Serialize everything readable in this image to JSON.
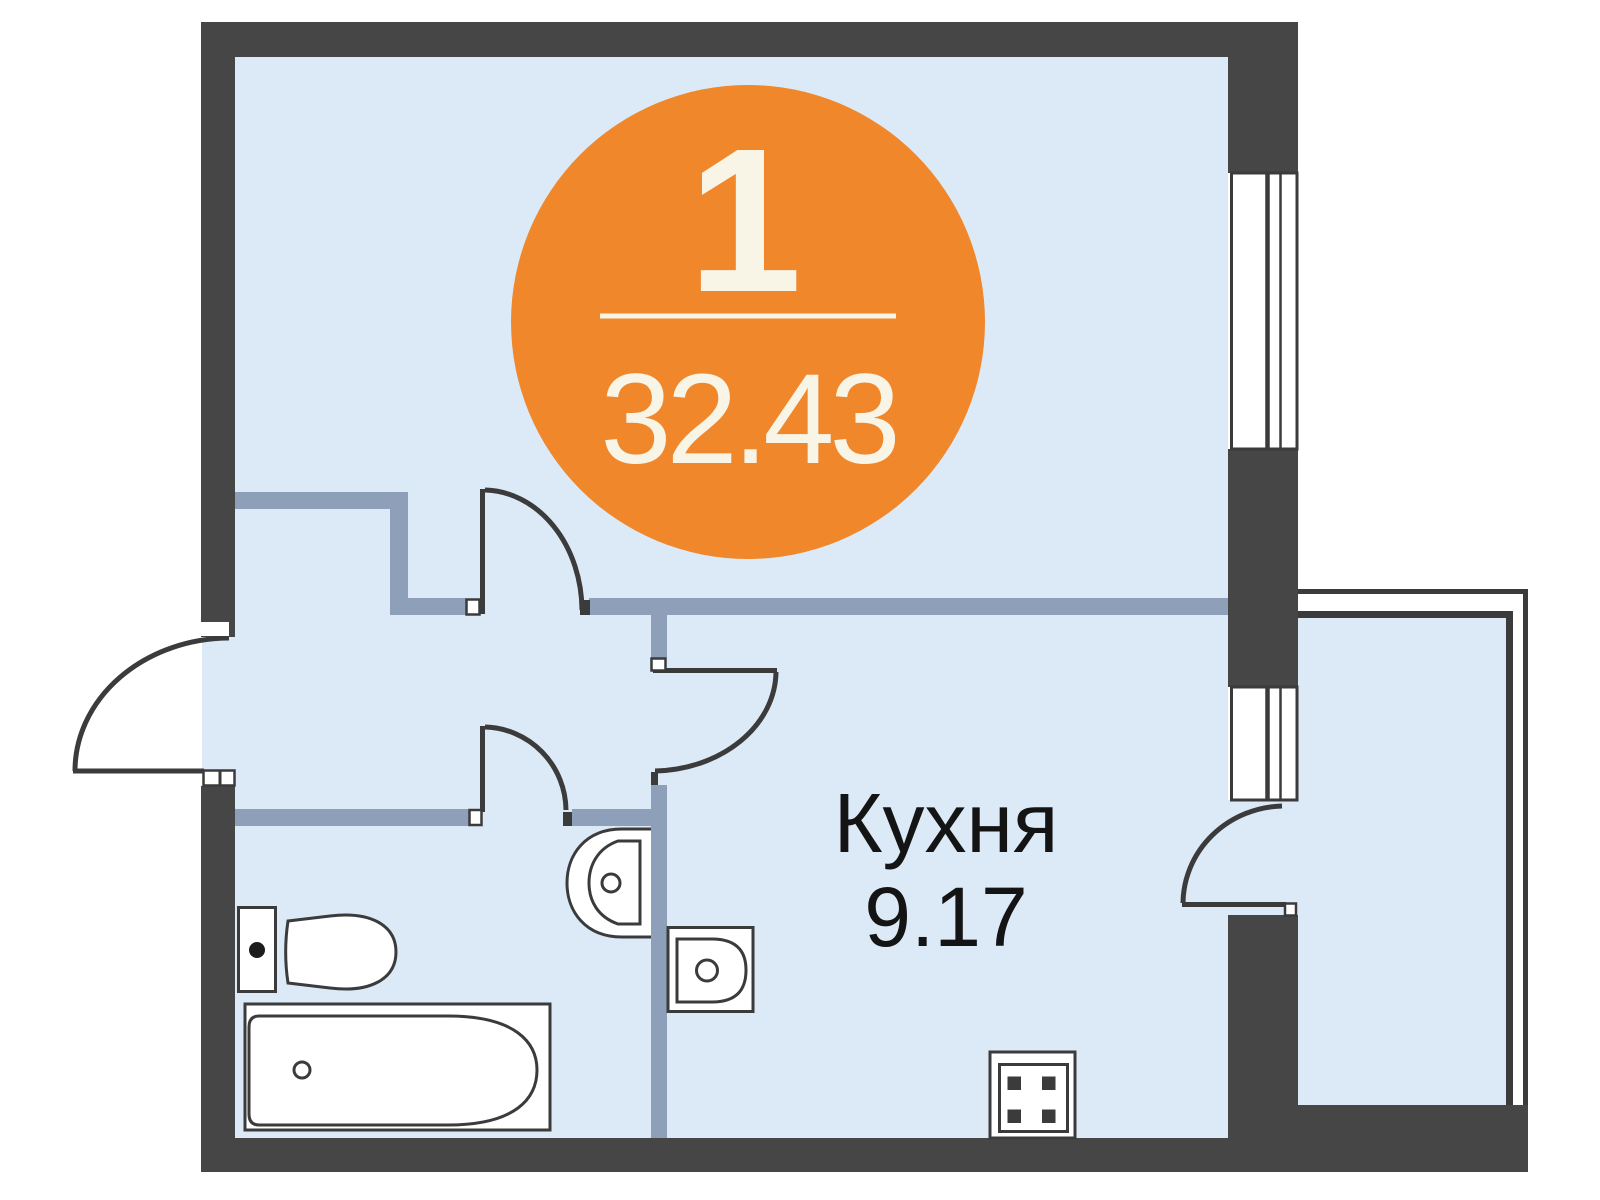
{
  "plan": {
    "badge": {
      "rooms_count": "1",
      "total_area": "32.43",
      "circle_color": "#F0872B",
      "text_color": "#F8F4E6"
    },
    "kitchen": {
      "name": "Кухня",
      "area": "9.17"
    },
    "colors": {
      "exterior_wall": "#464646",
      "partition": "#8E9FBA",
      "floor": "#DCEAF7",
      "outline": "#3B3B3B",
      "label_text": "#141414",
      "window_pane_living": "#FFFFFF",
      "window_pane_kitchen": "#DCEAF7"
    },
    "fixtures": [
      "toilet",
      "bathtub",
      "bathroom-sink",
      "kitchen-sink",
      "stove"
    ],
    "features": [
      "entry-door",
      "living-room-door",
      "bathroom-door",
      "kitchen-door",
      "balcony-door",
      "living-room-window",
      "kitchen-window",
      "balcony"
    ]
  }
}
